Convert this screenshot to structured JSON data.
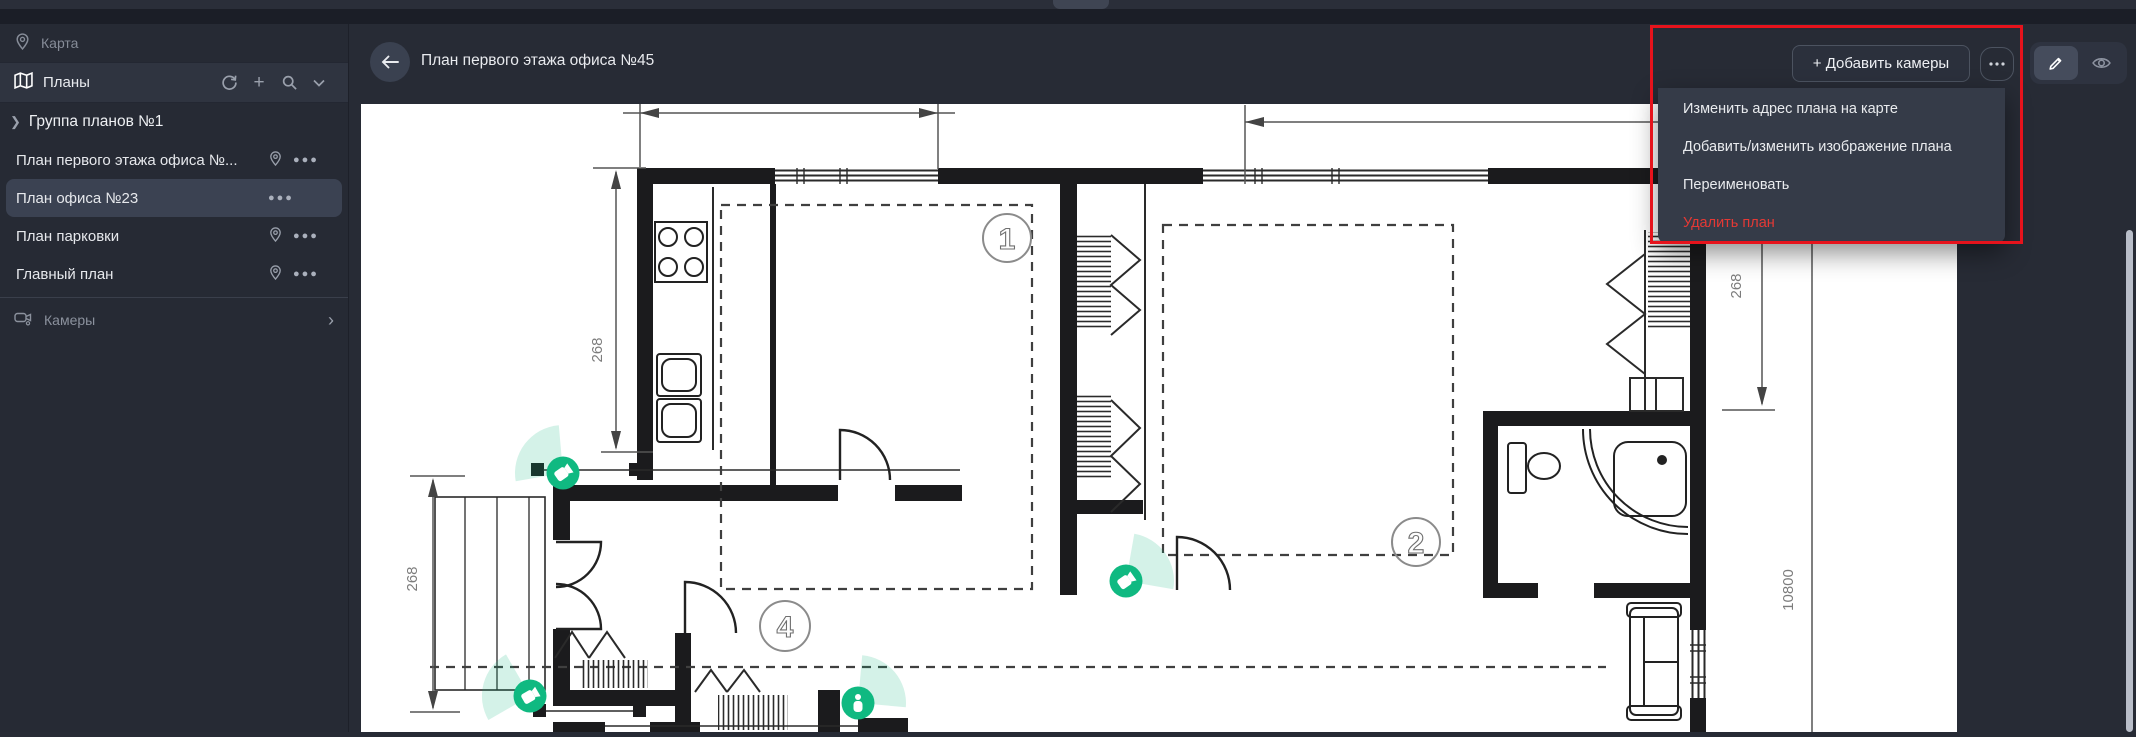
{
  "chrome": {
    "note": ""
  },
  "sidebar": {
    "map_label": "Карта",
    "plans_header": "Планы",
    "group_label": "Группа планов №1",
    "items": [
      {
        "label": "План первого этажа офиса №...",
        "has_pin": true,
        "selected": false
      },
      {
        "label": "План офиса №23",
        "has_pin": false,
        "selected": true
      },
      {
        "label": "План парковки",
        "has_pin": true,
        "selected": false
      },
      {
        "label": "Главный план",
        "has_pin": true,
        "selected": false
      }
    ],
    "cameras_label": "Камеры"
  },
  "header": {
    "title": "План первого этажа офиса №45",
    "add_cameras_label": "+ Добавить камеры",
    "more_label": "•••"
  },
  "menu": {
    "items": [
      {
        "label": "Изменить адрес плана на карте"
      },
      {
        "label": "Добавить/изменить изображение плана"
      },
      {
        "label": "Переименовать"
      },
      {
        "label": "Удалить план",
        "danger": true
      }
    ]
  },
  "plan": {
    "dims": {
      "v1": "268",
      "v2": "268",
      "v3": "268",
      "height": "10800"
    },
    "rooms": {
      "r1": "1",
      "r2": "2",
      "r4": "4"
    },
    "cameras_count": 4
  },
  "icons": {
    "map_pin": "location-pin",
    "map": "folded-map",
    "refresh": "circular-arrow",
    "add": "+",
    "search": "magnifier",
    "collapse": "chevron-down",
    "expand": "chevron-right",
    "more": "three-dots",
    "cameras": "video-camera",
    "back": "arrow-left",
    "edit": "pencil",
    "view": "eye"
  },
  "colors": {
    "accent_green": "#10b981",
    "annotation_red": "#e6131c",
    "danger_red": "#e53935",
    "sidebar_bg": "#262a34",
    "selected_bg": "#3b4252",
    "menu_bg": "#353b48"
  }
}
